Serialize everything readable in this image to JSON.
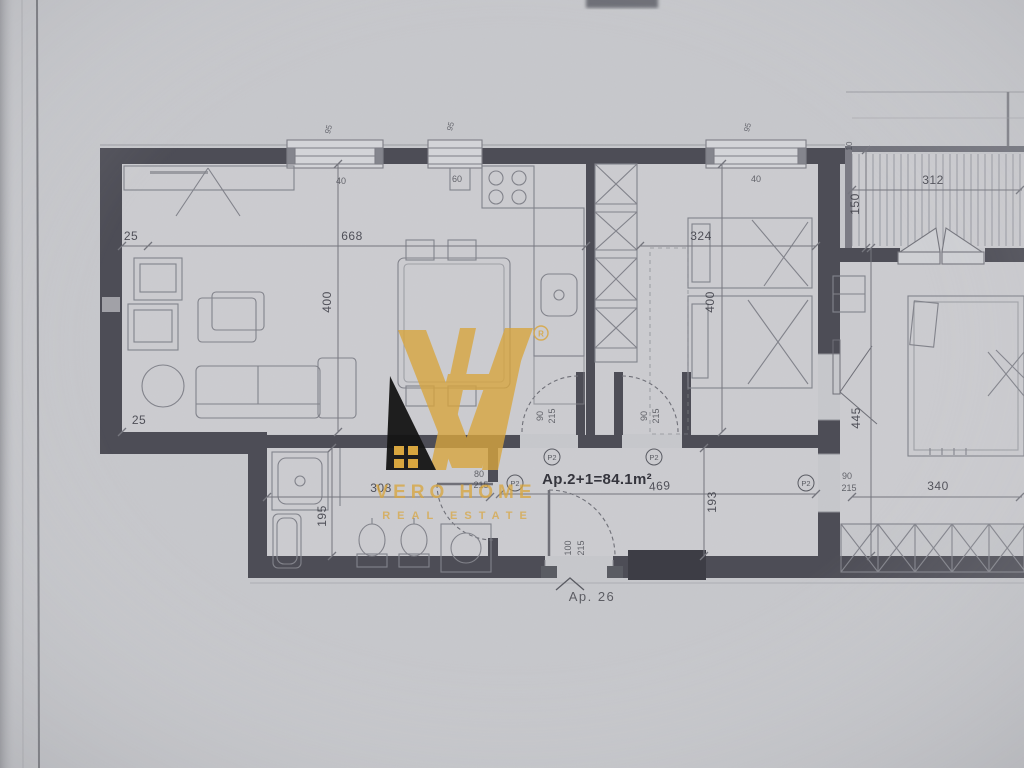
{
  "logo": {
    "monogram": "VH",
    "registered": "®",
    "line1": "VERO HOME",
    "line2": "REAL ESTATE",
    "gold": "#D8A63F",
    "black": "#141414"
  },
  "plan": {
    "area_label": "Ap.2+1=84.1m²",
    "adjacent_unit_label": "Ap. 26"
  },
  "dims": {
    "living_side_offset": "25",
    "living_width": "668",
    "living_height": "400",
    "living_bottom_offset": "25",
    "window1_width": "95",
    "window1_offset": "40",
    "window2_width": "95",
    "window2_offset": "60",
    "window3_width": "95",
    "window3_offset": "40",
    "bedroom_width": "324",
    "bedroom_height": "400",
    "balcony_width": "312",
    "balcony_depth": "150",
    "balcony_offset": "10",
    "room_right_height": "445",
    "room_right_width": "340",
    "corridor_width": "469",
    "corridor_height": "193",
    "bath_width": "308",
    "bath_height": "195",
    "door_width_90": "90",
    "door_width_80": "80",
    "door_width_100": "100",
    "door_height_215": "215",
    "door_tag": "P2"
  }
}
